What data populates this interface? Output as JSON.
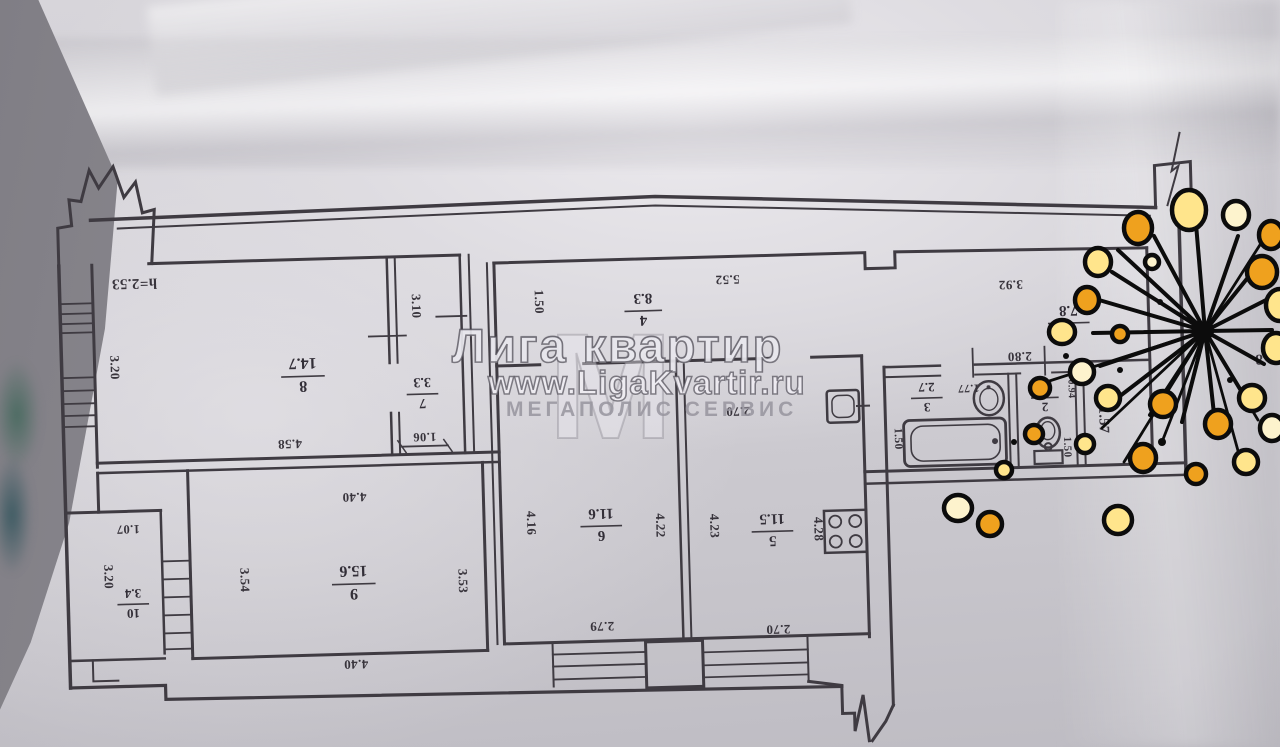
{
  "watermark": {
    "brand": "Лига квартир",
    "url": "www.LigaKvartir.ru",
    "subtitle": "МЕГАПОЛИС СЕРВИС",
    "logo_letter": "М"
  },
  "plan": {
    "ceiling_height": "h=2.53",
    "apartment_note": "кв. 8",
    "rooms": [
      {
        "num": "1",
        "area": "7.8",
        "x": 1070,
        "y": 336,
        "s": 15,
        "w": 40
      },
      {
        "num": "2",
        "area": "1.3",
        "x": 1044,
        "y": 410,
        "s": 13,
        "w": 26
      },
      {
        "num": "3",
        "area": "2.7",
        "x": 926,
        "y": 407,
        "s": 13,
        "w": 30
      },
      {
        "num": "4",
        "area": "8.3",
        "x": 645,
        "y": 312,
        "s": 15,
        "w": 36
      },
      {
        "num": "5",
        "area": "11.5",
        "x": 768,
        "y": 536,
        "s": 15,
        "w": 40
      },
      {
        "num": "6",
        "area": "11.6",
        "x": 597,
        "y": 526,
        "s": 15,
        "w": 40
      },
      {
        "num": "7",
        "area": "3.3",
        "x": 422,
        "y": 389,
        "s": 14,
        "w": 30
      },
      {
        "num": "8",
        "area": "14.7",
        "x": 303,
        "y": 368,
        "s": 16,
        "w": 42
      },
      {
        "num": "9",
        "area": "15.6",
        "x": 348,
        "y": 577,
        "s": 16,
        "w": 42
      },
      {
        "num": "10",
        "area": "3.4",
        "x": 127,
        "y": 591,
        "s": 13,
        "w": 30
      }
    ],
    "dims": [
      {
        "t": "h=2.53",
        "x": 137,
        "y": 265,
        "r": 180,
        "s": 15
      },
      {
        "t": "3.20",
        "x": 111,
        "y": 353,
        "r": 90,
        "s": 13
      },
      {
        "t": "4.58",
        "x": 288,
        "y": 430,
        "r": 180,
        "s": 13
      },
      {
        "t": "3.10",
        "x": 414,
        "y": 300,
        "r": 90,
        "s": 13
      },
      {
        "t": "1.06",
        "x": 423,
        "y": 427,
        "r": 180,
        "s": 12.5
      },
      {
        "t": "1.50",
        "x": 537,
        "y": 299,
        "r": 90,
        "s": 13
      },
      {
        "t": "5.52",
        "x": 730,
        "y": 278,
        "r": 180,
        "s": 13
      },
      {
        "t": "2.70",
        "x": 737,
        "y": 410,
        "r": 180,
        "s": 13
      },
      {
        "t": "3.92",
        "x": 1013,
        "y": 291,
        "r": 180,
        "s": 13
      },
      {
        "t": "2.80",
        "x": 1020,
        "y": 363,
        "r": 180,
        "s": 13
      },
      {
        "t": "1.77",
        "x": 968,
        "y": 394,
        "r": 180,
        "s": 11.5
      },
      {
        "t": "1.50",
        "x": 893,
        "y": 446,
        "r": 90,
        "s": 11.5
      },
      {
        "t": "0.94",
        "x": 1068,
        "y": 401,
        "r": 90,
        "s": 10
      },
      {
        "t": "1.50",
        "x": 1062,
        "y": 459,
        "r": 90,
        "s": 11
      },
      {
        "t": "1.57",
        "x": 1098,
        "y": 433,
        "r": 90,
        "s": 14.5
      },
      {
        "t": "4.16",
        "x": 523,
        "y": 520,
        "r": 90,
        "s": 13
      },
      {
        "t": "4.22",
        "x": 652,
        "y": 526,
        "r": 90,
        "s": 13
      },
      {
        "t": "2.79",
        "x": 595,
        "y": 621,
        "r": 180,
        "s": 13
      },
      {
        "t": "4.23",
        "x": 706,
        "y": 528,
        "r": 90,
        "s": 13
      },
      {
        "t": "4.28",
        "x": 810,
        "y": 534,
        "r": 90,
        "s": 13
      },
      {
        "t": "2.70",
        "x": 771,
        "y": 629,
        "r": 180,
        "s": 13
      },
      {
        "t": "4.40",
        "x": 351,
        "y": 485,
        "r": 180,
        "s": 13
      },
      {
        "t": "4.40",
        "x": 348,
        "y": 652,
        "r": 180,
        "s": 13
      },
      {
        "t": "3.54",
        "x": 235,
        "y": 569,
        "r": 90,
        "s": 13
      },
      {
        "t": "3.53",
        "x": 453,
        "y": 576,
        "r": 90,
        "s": 13
      },
      {
        "t": "1.07",
        "x": 124,
        "y": 511,
        "r": 180,
        "s": 12.5
      },
      {
        "t": "3.20",
        "x": 99,
        "y": 562,
        "r": 90,
        "s": 13
      },
      {
        "t": "кв. 8",
        "x": 1272,
        "y": 372,
        "r": 180,
        "s": 15
      }
    ]
  },
  "colors": {
    "ink": "#3f3b42",
    "paper": "#d2d0d6",
    "watermark": "#eceaf0",
    "blob_orange": "#efa11e",
    "blob_yellow": "#ffe58c",
    "blob_cream": "#fdf3cd",
    "blob_outline": "#0c0c0c"
  }
}
